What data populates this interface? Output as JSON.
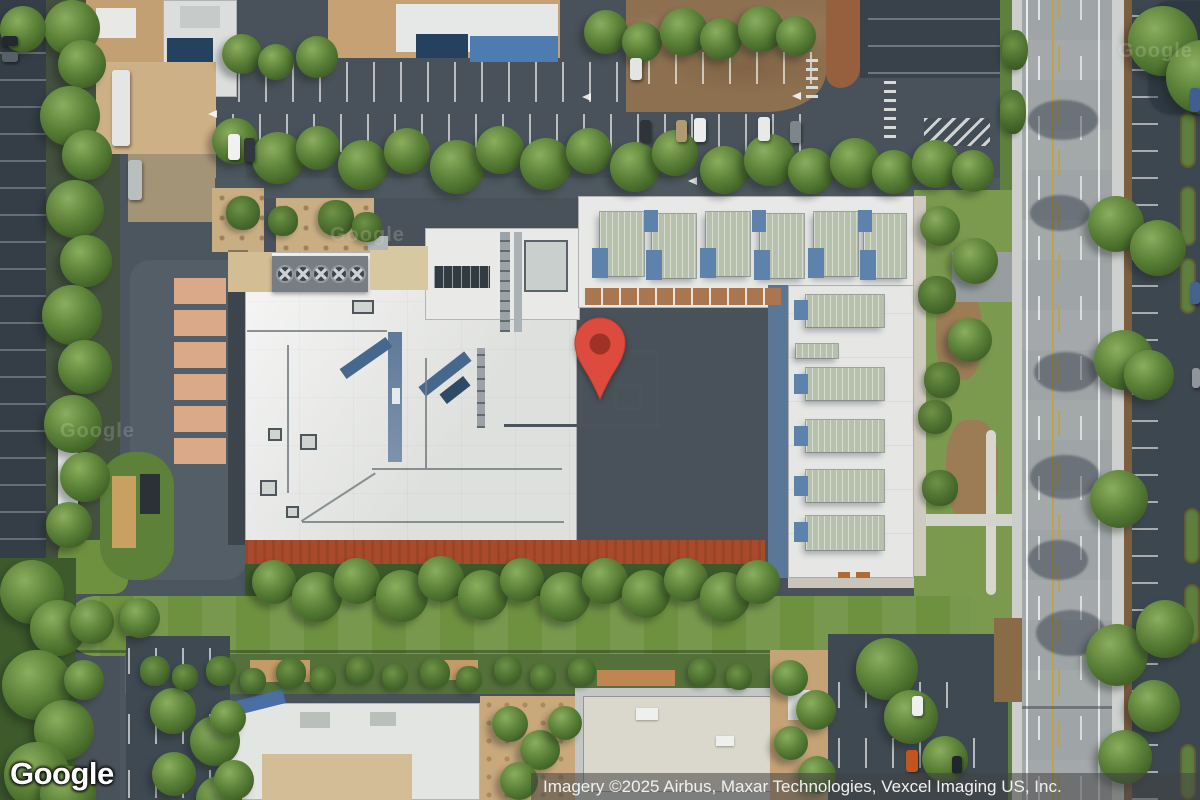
{
  "map": {
    "view_type": "satellite",
    "logo_text": "Google",
    "watermark_text": "Google",
    "attribution_text": "Imagery ©2025 Airbus, Maxar Technologies, Vexcel Imaging US, Inc.",
    "marker": {
      "icon": "location-pin",
      "fill_color": "#DD4B3E",
      "dot_color": "#9E3226"
    },
    "colors": {
      "attribution_bar": "rgba(66,66,66,0.55)",
      "attribution_text": "#F1F1F1",
      "asphalt": "#49525A",
      "roof_white": "#EBECEA",
      "lawn_green": "#6E9140",
      "dirt_field": "#8D7050",
      "track_red": "#A84A2B",
      "road_gray": "#9FA4A6"
    }
  }
}
